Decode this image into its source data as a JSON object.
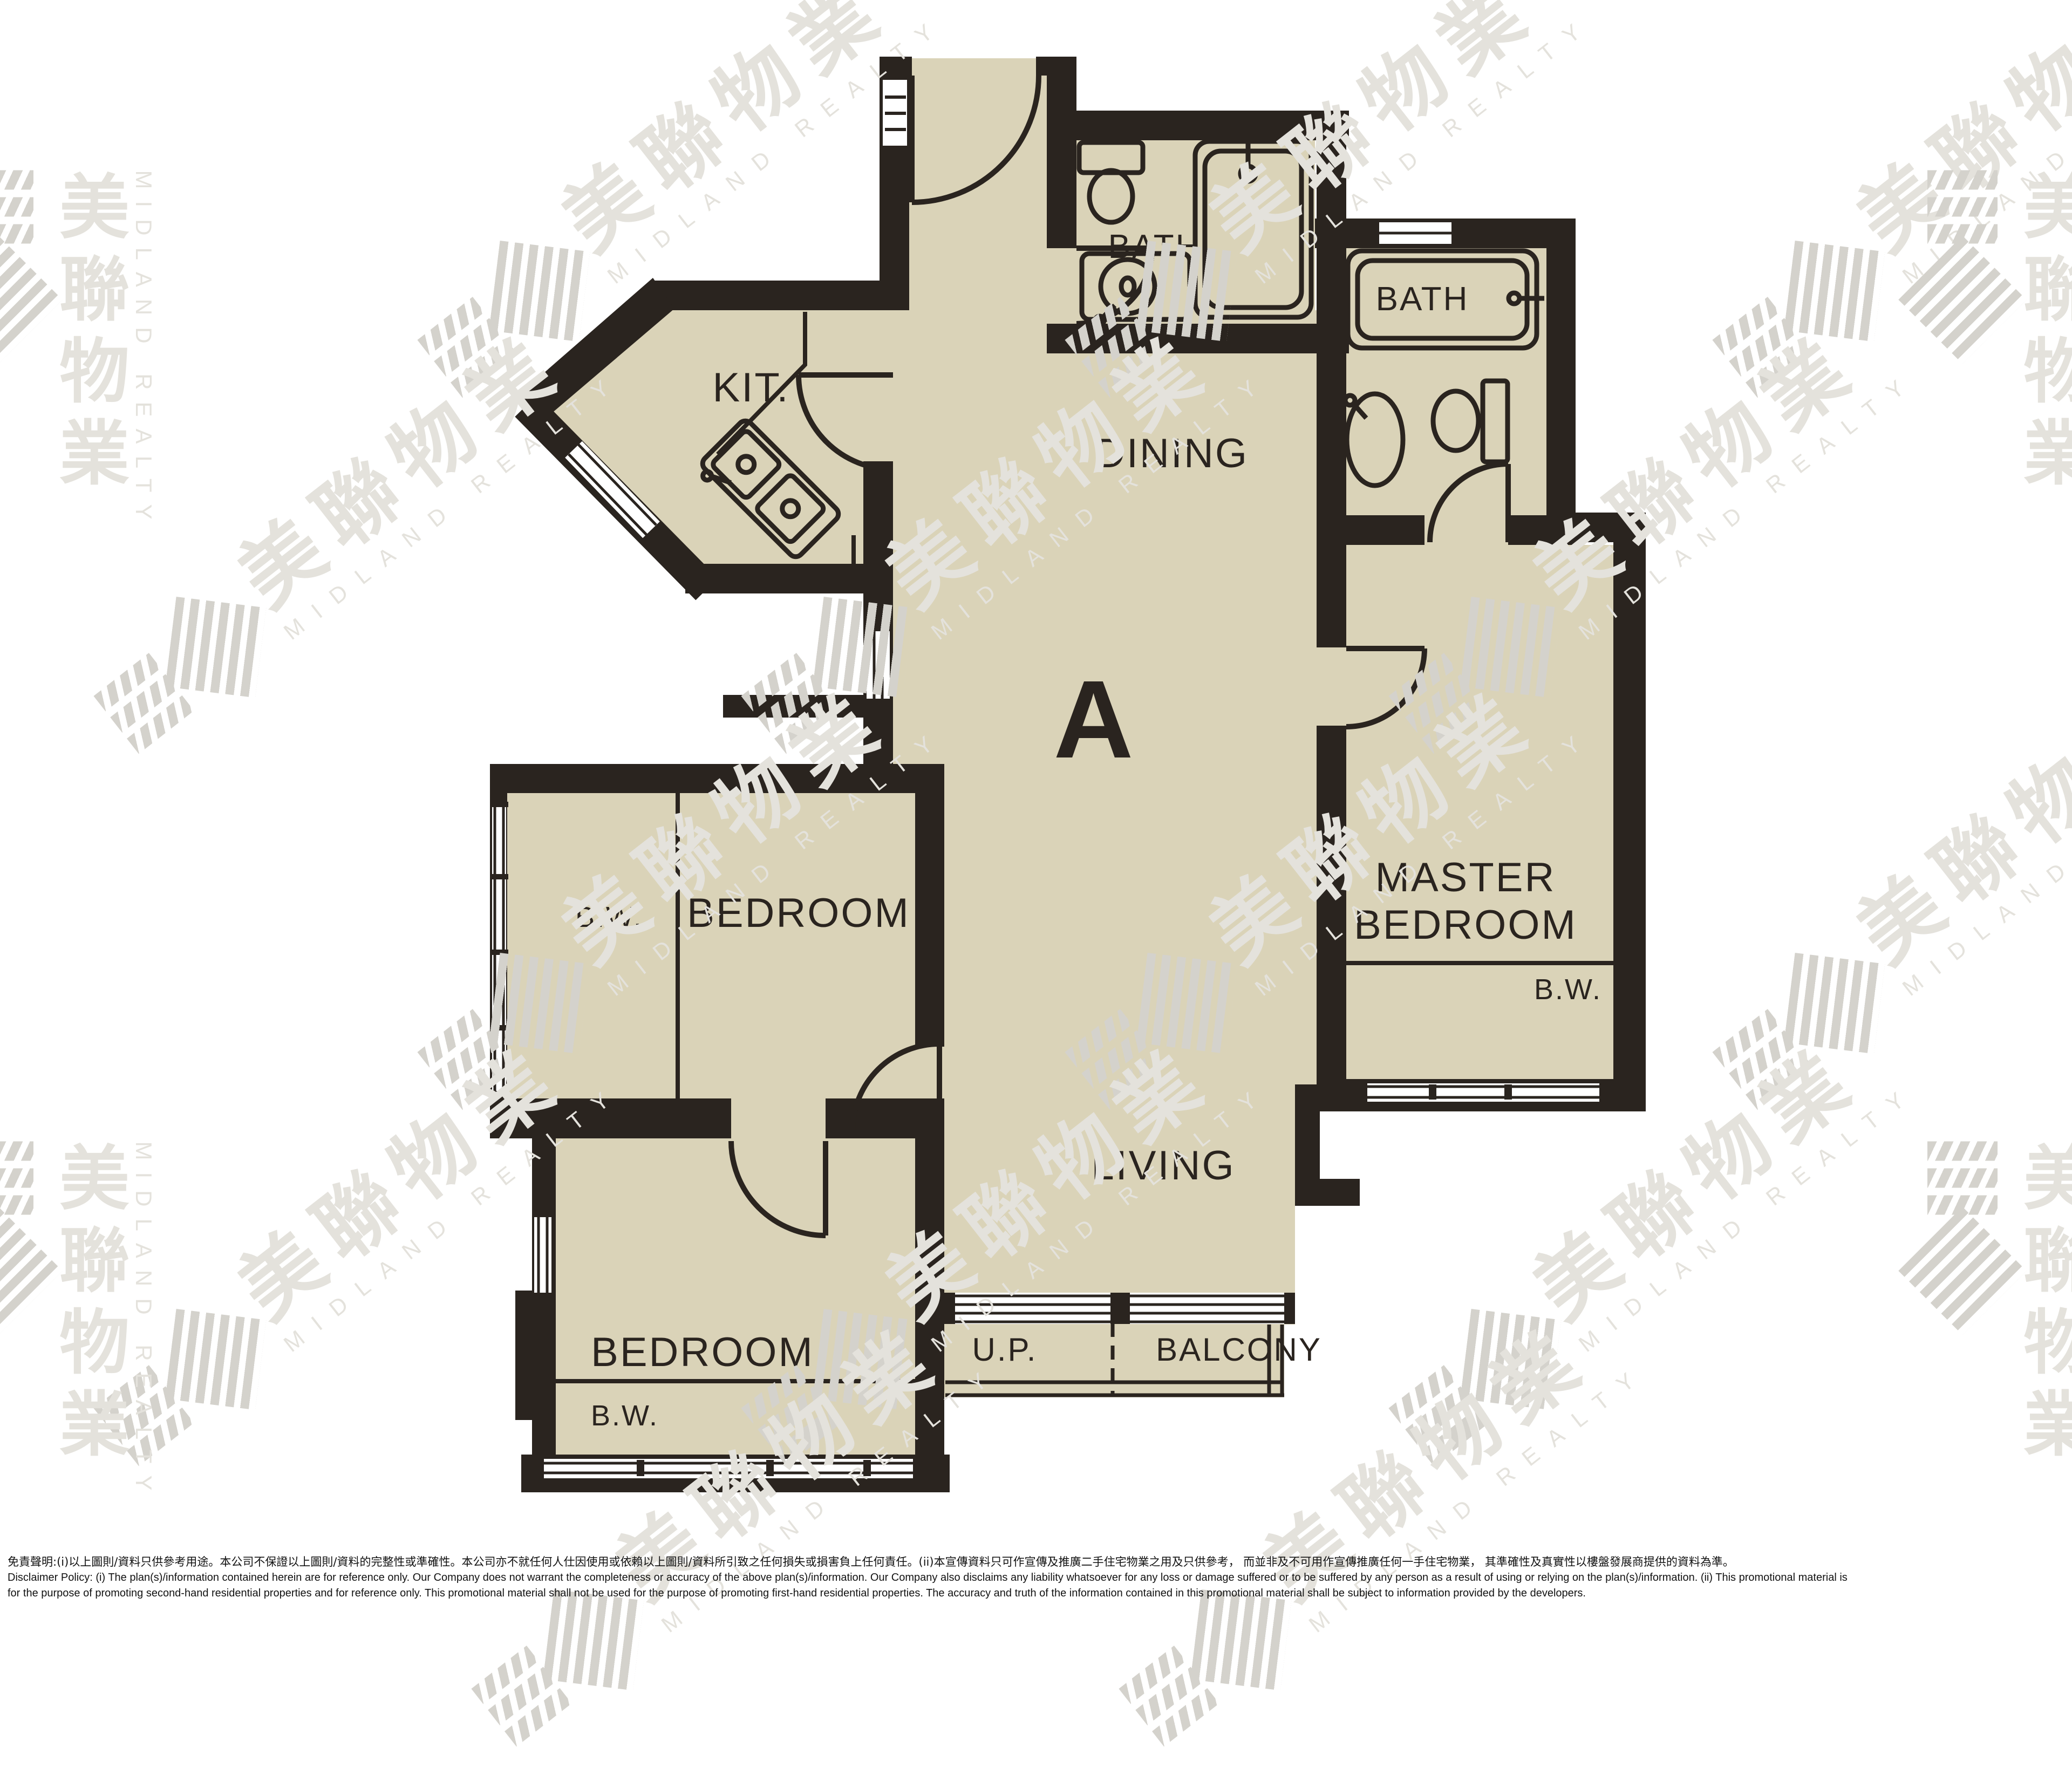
{
  "labels": {
    "unit": "A",
    "dining": "DINING",
    "living": "LIVING",
    "kitchen": "KIT.",
    "bath_top": "BATH",
    "bath_master": "BATH",
    "bedroom_left": "BEDROOM",
    "bedroom_bottom": "BEDROOM",
    "master_line1": "MASTER",
    "master_line2": "BEDROOM",
    "balcony": "BALCONY",
    "utility_platform": "U.P.",
    "bw_bedroom_left": "B.W.",
    "bw_bedroom_bottom": "B.W.",
    "bw_master": "B.W."
  },
  "watermark": {
    "cn": "美聯物業",
    "en": "MIDLAND REALTY"
  },
  "disclaimer": {
    "cn": "免責聲明:(i)以上圖則/資料只供參考用途。本公司不保證以上圖則/資料的完整性或準確性。本公司亦不就任何人仕因使用或依賴以上圖則/資料所引致之任何損失或損害負上任何責任。(ii)本宣傳資料只可作宣傳及推廣二手住宅物業之用及只供參考， 而並非及不可用作宣傳推廣任何一手住宅物業， 其準確性及真實性以樓盤發展商提供的資料為準。",
    "en_line1": "Disclaimer Policy: (i) The plan(s)/information contained herein are for reference only. Our Company does not warrant the completeness or accuracy of the above plan(s)/information. Our Company also disclaims any liability whatsoever for any loss or damage suffered or to be suffered by any person as a result of using or relying on the plan(s)/information. (ii) This promotional material is",
    "en_line2": "for the purpose of promoting second-hand residential properties and for reference only. This promotional material shall not be used for the purpose of promoting first-hand residential properties. The accuracy and truth of the information contained in this promotional material shall be subject to information provided by the developers."
  },
  "colors": {
    "floor": "#dad3b8",
    "wall": "#2a241f",
    "wm": "#e4e2dc",
    "wmstripe": "#d4d2cc"
  }
}
